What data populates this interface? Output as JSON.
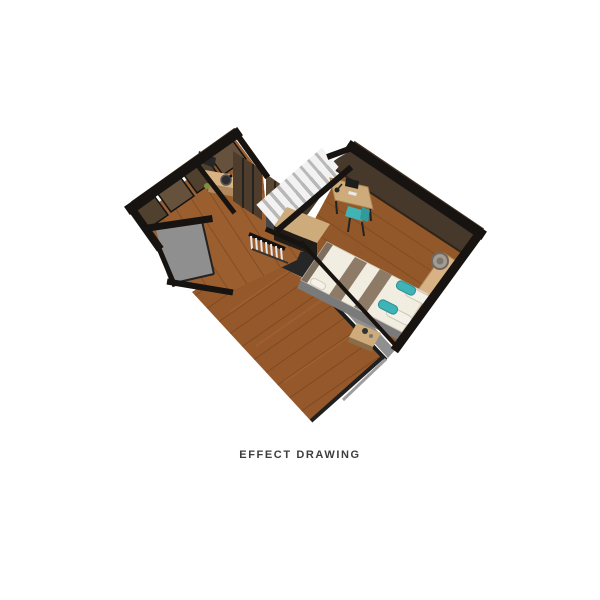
{
  "caption": {
    "text": "EFFECT DRAWING"
  },
  "palette": {
    "wall": "#171310",
    "wall_accent": "#3e3122",
    "wood_lower": "#95582b",
    "wood_upper": "#9b5e2f",
    "wood_bedroom": "#935829",
    "plank_line": "#6e3e1b",
    "panel_light": "#65513c",
    "panel_dark": "#50402e",
    "wardrobe": "#4e3d2c",
    "counter": "#d9b383",
    "light_wood": "#cdab7b",
    "gray_floor": "#8f8f8f",
    "gray_face": "#6d6d6d",
    "gray_dark": "#3f3f3f",
    "void": "#262626",
    "stair_tread": "#f2f2f2",
    "stair_riser": "#b9b9b9",
    "bed_white": "#f1ede1",
    "bed_stripe": "#8d7b67",
    "bed_frame": "#7a7a7a",
    "teal": "#3fb3b5",
    "shelf": "#d8b184",
    "caption_color": "#3d3d3d"
  },
  "scene": {
    "type": "3d-floor-plan-effect-rendering",
    "rooms": [
      "bedroom",
      "vanity-room",
      "hallway",
      "stairwell",
      "lower-living-area"
    ],
    "furniture": [
      "double-bed",
      "desk",
      "desk-chair",
      "nightstand",
      "headboard-shelf",
      "basket",
      "vanity-counter",
      "sink",
      "wardrobe",
      "stairs",
      "railing"
    ]
  }
}
